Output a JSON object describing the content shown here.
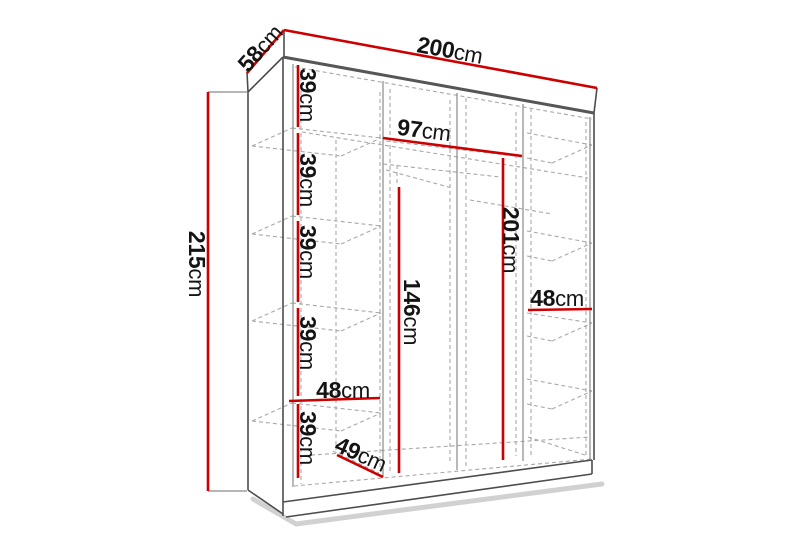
{
  "diagram": {
    "type": "wardrobe-dimension-diagram",
    "unit": "cm",
    "accent_color": "#cc0000",
    "line_color": "#4d4d4d",
    "labels": {
      "width": {
        "value": "200",
        "unit": "cm"
      },
      "depth": {
        "value": "58",
        "unit": "cm"
      },
      "height": {
        "value": "215",
        "unit": "cm"
      },
      "shelf_1": {
        "value": "39",
        "unit": "cm"
      },
      "shelf_2": {
        "value": "39",
        "unit": "cm"
      },
      "shelf_3": {
        "value": "39",
        "unit": "cm"
      },
      "shelf_4": {
        "value": "39",
        "unit": "cm"
      },
      "shelf_5": {
        "value": "39",
        "unit": "cm"
      },
      "middle_width": {
        "value": "97",
        "unit": "cm"
      },
      "interior_height": {
        "value": "201",
        "unit": "cm"
      },
      "hanging_height": {
        "value": "146",
        "unit": "cm"
      },
      "shelf_width_left": {
        "value": "48",
        "unit": "cm"
      },
      "shelf_width_right": {
        "value": "48",
        "unit": "cm"
      },
      "interior_depth": {
        "value": "49",
        "unit": "cm"
      }
    }
  }
}
